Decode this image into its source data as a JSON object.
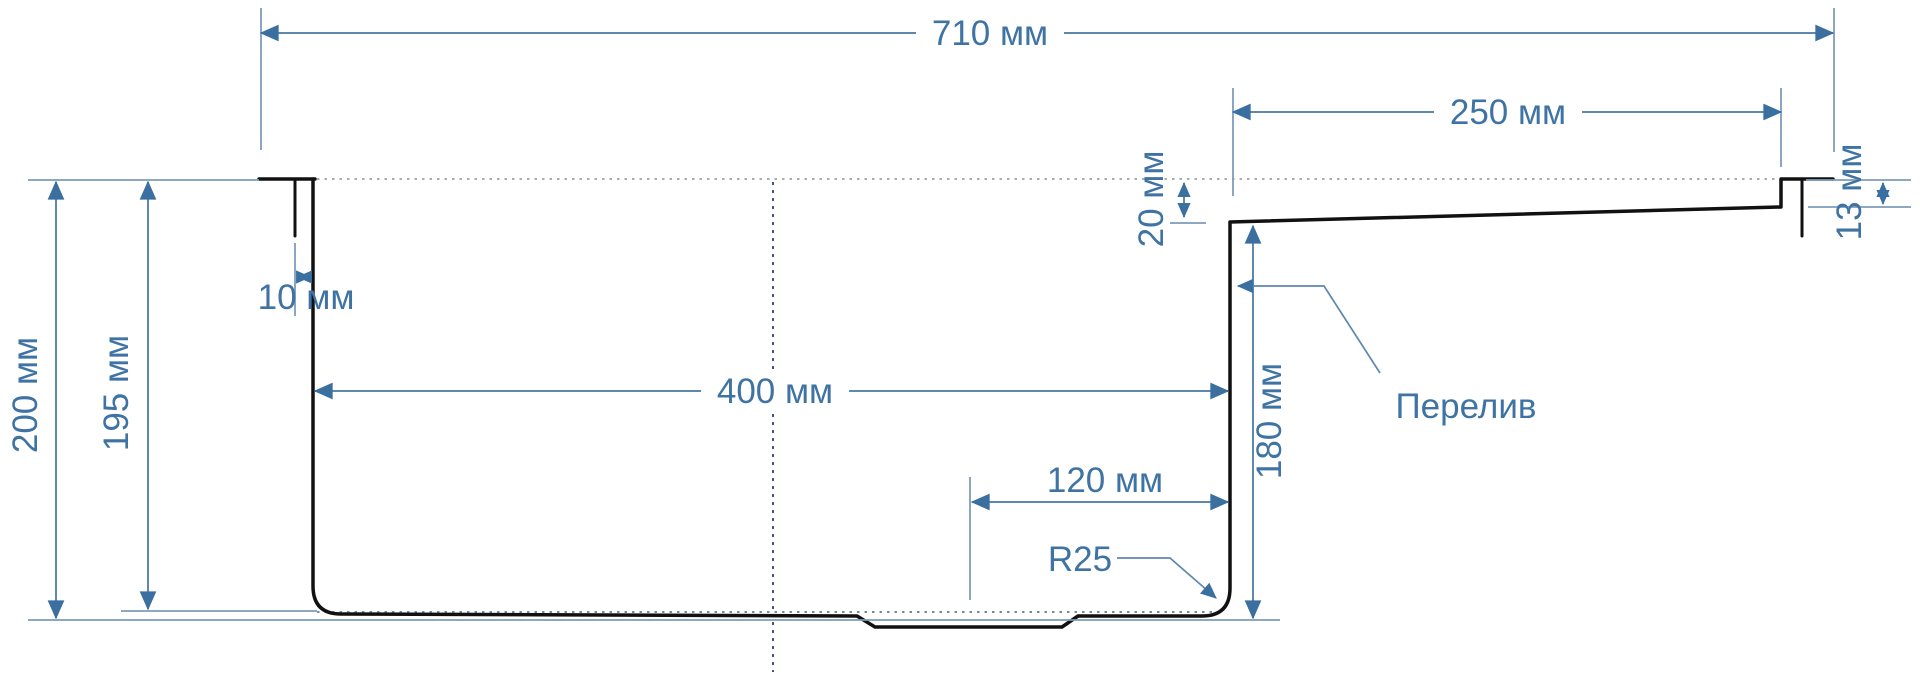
{
  "diagram": {
    "type": "technical-drawing",
    "subject": "sink-cross-section",
    "units": "мм",
    "colors": {
      "dimension_text": "#3e73a3",
      "dimension_line": "#5e88b0",
      "extension_line": "#7d9cba",
      "outline": "#111111",
      "background": "#ffffff"
    },
    "dimensions": {
      "overall_width": {
        "label": "710 мм",
        "value": 710,
        "unit": "мм",
        "orientation": "horizontal"
      },
      "drainboard_width": {
        "label": "250 мм",
        "value": 250,
        "unit": "мм",
        "orientation": "horizontal"
      },
      "drainboard_drop": {
        "label": "20 мм",
        "value": 20,
        "unit": "мм",
        "orientation": "vertical"
      },
      "rim_edge_height": {
        "label": "13 мм",
        "value": 13,
        "unit": "мм",
        "orientation": "vertical"
      },
      "mounting_lip": {
        "label": "10 мм",
        "value": 10,
        "unit": "мм",
        "orientation": "horizontal"
      },
      "overall_depth": {
        "label": "200 мм",
        "value": 200,
        "unit": "мм",
        "orientation": "vertical"
      },
      "inner_depth": {
        "label": "195 мм",
        "value": 195,
        "unit": "мм",
        "orientation": "vertical"
      },
      "bowl_width": {
        "label": "400 мм",
        "value": 400,
        "unit": "мм",
        "orientation": "horizontal"
      },
      "drain_offset": {
        "label": "120 мм",
        "value": 120,
        "unit": "мм",
        "orientation": "horizontal"
      },
      "bowl_depth": {
        "label": "180 мм",
        "value": 180,
        "unit": "мм",
        "orientation": "vertical"
      }
    },
    "annotations": {
      "corner_radius": {
        "label": "R25",
        "value": 25,
        "unit": "мм"
      },
      "overflow": {
        "label": "Перелив"
      }
    }
  }
}
